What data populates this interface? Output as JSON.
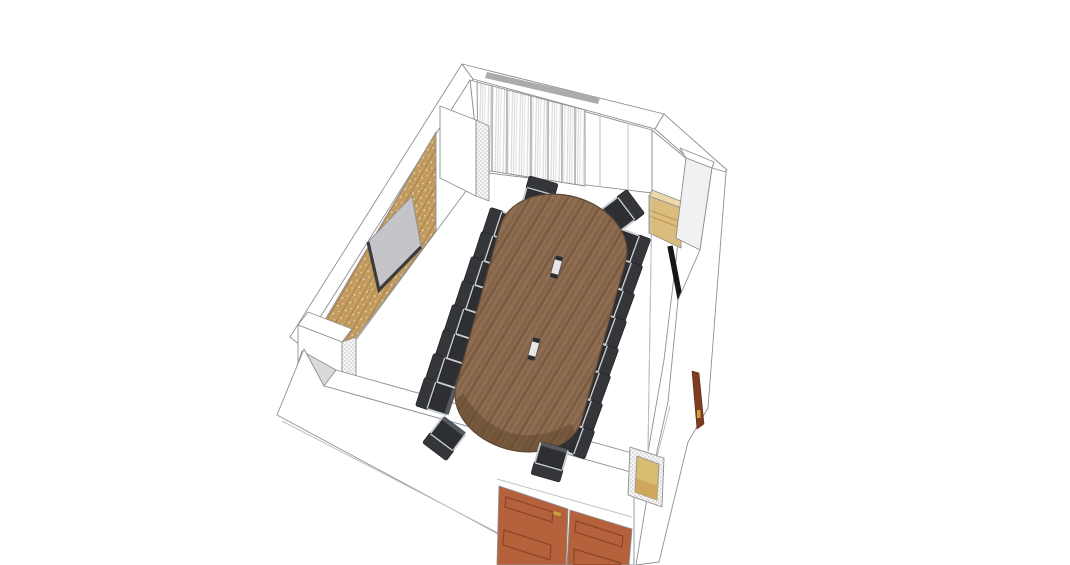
{
  "view": {
    "width": 1070,
    "height": 565,
    "background": "#ffffff",
    "style": "sketchup-like-3d-render",
    "subject": "conference room 3D model, bird's-eye perspective"
  },
  "scene": {
    "colors": {
      "background": "#ffffff",
      "outline": "#8f8f8f",
      "seam": "#c2c2c2",
      "wall_gray_face": "#dadada",
      "wall_light": "#f2f2f2",
      "dither_bg": "#f7f7f7",
      "dither": "#d2d2d2",
      "wood_panel_base": "#c49d62",
      "wood_panel_line1": "#aa8149",
      "wood_panel_line2": "#b68f55",
      "wood_panel_dot": "#ecdcb4",
      "wood_panel_outline": "#8a7148",
      "screen_fill": "#c5c5c9",
      "screen_frame": "#3c3c3c",
      "curtain_base": "#ffffff",
      "curtain_stripe1": "#d9d9d9",
      "curtain_stripe2": "#cccccc",
      "curtain_stripe3": "#e7e7e7",
      "curtain_dark_fold": "#9c9c9c",
      "curtain_rail": "#ababab",
      "corner_accent": "#8b3a1e",
      "table_grain": [
        "#83644a",
        "#8d6c50",
        "#7b5c42",
        "#907054",
        "#866548",
        "#8f6e52"
      ],
      "table_edge_shade": "#63492f",
      "table_outline": "#5f4936",
      "grommet_body": "#e6e6e6",
      "grommet_end": "#2c2c2c",
      "chair_back": "#35363a",
      "chair_seat": "#2e2f33",
      "chair_seat_light": "#55585e",
      "chair_frame": "#c7ccd1",
      "door": "#b4613c",
      "door_edge": "#7c3f24",
      "door_panel": "#8a4526",
      "handle_gold": "#c9a23a",
      "cabinet": "#dcbc7d",
      "cabinet_top": "#ecd9a8",
      "cabinet_line": "#b99555",
      "tv_strip": "#161616",
      "side_door": "#7e3c20",
      "radiator": "#d9bc72",
      "radiator_low": "#cfa75c",
      "radiator_edge": "#9b7a3e"
    },
    "objects": [
      {
        "name": "back-left-wall",
        "features": [
          "wood-slat-acoustic-panel",
          "projection-screen",
          "white-pilaster-columns"
        ]
      },
      {
        "name": "back-wall",
        "features": [
          "vertical-striped-curtain",
          "curtain-rail",
          "white-panels"
        ]
      },
      {
        "name": "right-wall",
        "features": [
          "wall-mounted-cabinet",
          "flat-screen-edge-on",
          "open-side-door-with-gold-handle",
          "pilaster-column"
        ]
      },
      {
        "name": "front-wall",
        "features": [
          "terracotta-double-entry-door",
          "gold-door-handle",
          "radiator-unit"
        ]
      },
      {
        "name": "conference-table",
        "shape": "racetrack-oval",
        "material": "walnut-wood",
        "grommets": 2
      },
      {
        "name": "office-chairs",
        "count": 20,
        "style": "dark-upholstery-aluminum-frame"
      }
    ],
    "table": {
      "cx": 541,
      "cy": 323,
      "rotation": 15.5,
      "width": 130,
      "length": 261,
      "end_flatten": 48,
      "grommets": [
        {
          "offset": -58
        },
        {
          "offset": 27
        }
      ]
    },
    "chairs": {
      "main": [
        {
          "x": 506,
          "y": 228,
          "r": 108
        },
        {
          "x": 497,
          "y": 252,
          "r": 108
        },
        {
          "x": 487,
          "y": 277,
          "r": 108
        },
        {
          "x": 478,
          "y": 301,
          "r": 108
        },
        {
          "x": 468,
          "y": 325,
          "r": 108
        },
        {
          "x": 459,
          "y": 350,
          "r": 108
        },
        {
          "x": 449,
          "y": 374,
          "r": 108
        },
        {
          "x": 440,
          "y": 398,
          "r": 108
        },
        {
          "x": 626,
          "y": 246,
          "r": -70
        },
        {
          "x": 618,
          "y": 273,
          "r": -70
        },
        {
          "x": 610,
          "y": 301,
          "r": -70
        },
        {
          "x": 602,
          "y": 328,
          "r": -70
        },
        {
          "x": 594,
          "y": 356,
          "r": -70
        },
        {
          "x": 586,
          "y": 383,
          "r": -70
        },
        {
          "x": 578,
          "y": 411,
          "r": -70
        },
        {
          "x": 570,
          "y": 438,
          "r": -70
        },
        {
          "x": 538,
          "y": 200,
          "r": 196
        },
        {
          "x": 619,
          "y": 214,
          "r": 233
        }
      ],
      "front": [
        {
          "x": 447,
          "y": 435,
          "r": 37
        },
        {
          "x": 551,
          "y": 458,
          "r": 16
        }
      ]
    }
  }
}
